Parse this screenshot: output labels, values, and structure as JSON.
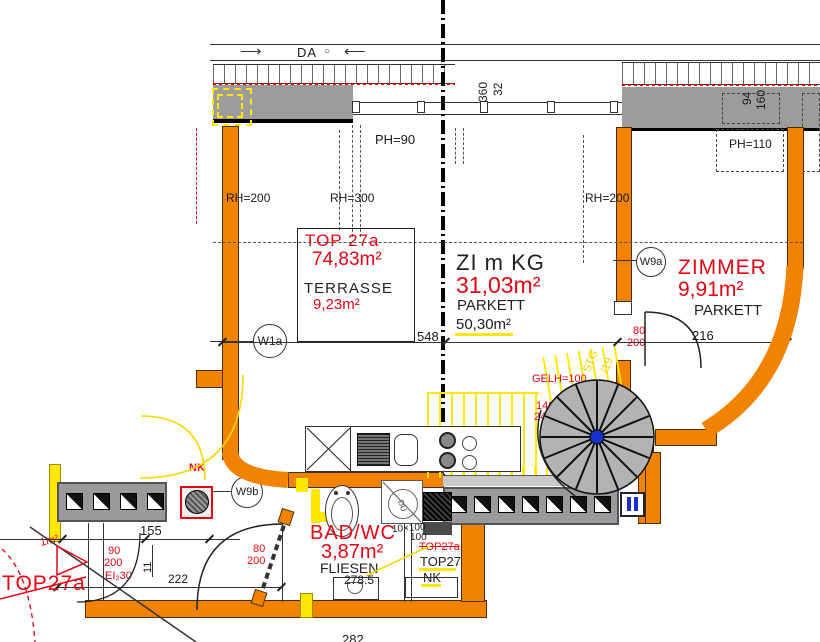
{
  "roof": {
    "da": "DA",
    "arrow_l": "⟶",
    "arrow_r": "⟵",
    "sym": "○",
    "ph90": "PH=90",
    "ph110": "PH=110",
    "d360": "360",
    "d32": "32",
    "d94": "94",
    "d160": "160"
  },
  "unit": {
    "top": "TOP 27a",
    "area": "74,83m²",
    "name": "TERRASSE",
    "tarea": "9,23m²"
  },
  "living": {
    "name": "ZI m KG",
    "area": "31,03m²",
    "floor": "PARKETT",
    "farea": "50,30m²"
  },
  "zimmer": {
    "name": "ZIMMER",
    "area": "9,91m²",
    "floor": "PARKETT",
    "door_w": "80",
    "door_h": "200"
  },
  "stair": {
    "gelh": "GELH=100",
    "steps": "14STG",
    "ratio": "24/20",
    "radius": "80",
    "ystg": "STG",
    "y19": "/19"
  },
  "heights": {
    "left": "RH=200",
    "mid": "RH=300",
    "right": "RH=200"
  },
  "windows": {
    "w1a": "W1a",
    "w9a": "W9a",
    "w9b": "W9b"
  },
  "dims": {
    "d548": "548",
    "d216": "216",
    "d155": "155",
    "d11": "11",
    "d222": "222",
    "d2785": "278.5",
    "cut": "282"
  },
  "entry": {
    "w": "90",
    "h": "200",
    "fire": "EI₂30"
  },
  "bad": {
    "name": "BAD/WC",
    "area": "3,87m²",
    "floor": "FLIESEN",
    "door_w": "80",
    "door_h": "200",
    "du": "DU",
    "note1": "10×100",
    "note2": "100"
  },
  "nk": {
    "strike": "TOP27a",
    "name": "TOP27",
    "sub": "NK"
  },
  "misc": {
    "top27a": "TOP27a",
    "nk_red": "NK",
    "frag": "1m²"
  },
  "colors": {
    "wall_orange": "#f28300",
    "highlight_yellow": "#ffe800",
    "annotation_red": "#e30613",
    "parapet_gray": "#9c9c9c"
  }
}
